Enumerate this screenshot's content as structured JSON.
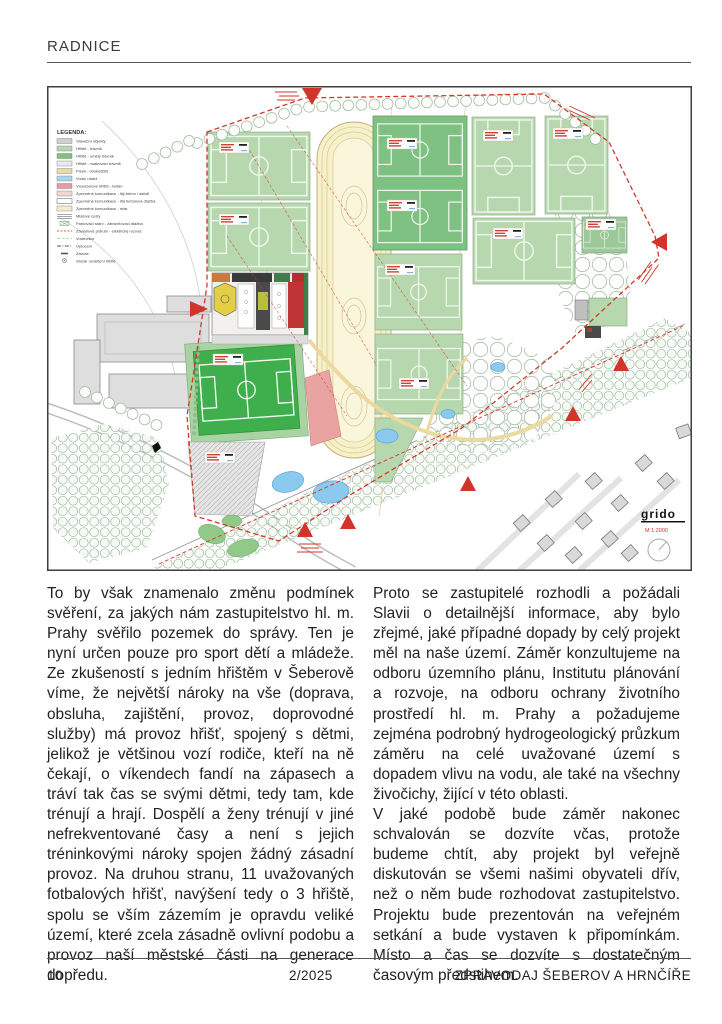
{
  "header": {
    "title": "RADNICE"
  },
  "article": {
    "left_column": {
      "p1": "To by však znamenalo změnu podmínek svěření, za jakých nám zastupitelstvo hl. m. Prahy svěřilo pozemek do správy. Ten je nyní určen pouze pro sport dětí a mládeže. Ze zkušeností s jedním hřištěm v Šeberově víme, že největší nároky na vše (doprava, obsluha, zajištění, provoz, doprovodné služby) má provoz hřišť, spojený s dětmi, jelikož je většinou vozí rodiče, kteří na ně čekají, o víkendech fandí na zápasech a tráví tak čas se svými dětmi, tedy tam, kde trénují a hrají. Dospělí a ženy trénují v jiné nefrekventované časy a není s jejich tréninkovými nároky spojen žádný zásadní provoz. Na druhou stranu, 11 uvažovaných fotbalových hřišť, navýšení tedy o 3 hřiště, spolu se vším zázemím je opravdu veliké území, které zcela zásadně ovlivní podobu a provoz naší městské části na generace dopředu."
    },
    "right_column": {
      "p1": "Proto se zastupitelé rozhodli a požádali Slavii o detailnější informace, aby bylo zřejmé, jaké případné dopady by celý projekt měl na naše území. Záměr konzultujeme na odboru územního plánu, Institutu plánování a rozvoje, na odboru ochrany životního prostředí hl. m. Prahy a požadujeme zejména podrobný hydrogeologický průzkum záměru na celé uvažované území s dopadem vlivu na vodu, ale také na všechny živočichy, žijící v této oblasti.",
      "p2": "V jaké podobě bude záměr nakonec schvalován se dozvíte včas, protože budeme chtít, aby projekt byl veřejně diskutován se všemi našimi obyvateli dřív, než o něm bude rozhodovat zastupitelstvo. Projektu bude prezentován na veřejném setkání a bude vystaven k připomínkám. Místo a čas se dozvíte s dostatečným časovým předstihem."
    }
  },
  "footer": {
    "page_number": "10",
    "issue": "2/2025",
    "newsletter_title": "ZPRAVODAJ ŠEBEROV A HRNČÍŘE"
  },
  "map": {
    "legend": {
      "title": "LEGENDA:",
      "items": [
        {
          "label": "Stavební objekty",
          "color": "#cfcfcf"
        },
        {
          "label": "Hřiště - trávník",
          "color": "#b7d8ae"
        },
        {
          "label": "Hřiště - umělý trávník",
          "color": "#7fc083"
        },
        {
          "label": "Hřiště - vsakovací trávník",
          "color": "#e9e9e9"
        },
        {
          "label": "Písek - doskočiště",
          "color": "#ecd9a4"
        },
        {
          "label": "Vodní nádrž",
          "color": "#a9d5f0"
        },
        {
          "label": "Víceúčelové hřiště - tartan",
          "color": "#e69c9c"
        },
        {
          "label": "Zpevněné komunikace - litý beton / asfalt",
          "color": "#f0d6d6"
        },
        {
          "label": "Zpevněné komunikace - litá betonová dlažba",
          "color": "#ffffff"
        },
        {
          "label": "Zpevněné komunikace - mlat",
          "color": "#f6eccd"
        },
        {
          "label": "Mlatové cesty",
          "color": null
        },
        {
          "label": "Parkovací stání - zatravňovací dlažba",
          "color": null
        },
        {
          "label": "Závlahové potrubí - elektrický rozvod",
          "color": null
        },
        {
          "label": "Vrstevnice",
          "color": null
        },
        {
          "label": "Oplocení",
          "color": null
        },
        {
          "label": "Závora",
          "color": null
        },
        {
          "label": "Stožár osvětlení hřiště",
          "color": null
        }
      ]
    },
    "branding": {
      "logo": "grido",
      "scale": "M 1:2000"
    },
    "colors": {
      "field_light": "#b7d8ae",
      "field_dark": "#7fc083",
      "pitch_bright": "#3fae4c",
      "track": "#f6f1c8",
      "tartan": "#e69c9c",
      "water": "#8cc9ee",
      "marker_red": "#d0342a",
      "boundary_red": "#cf3a2a",
      "building_gray": "#dcdcdc"
    }
  }
}
